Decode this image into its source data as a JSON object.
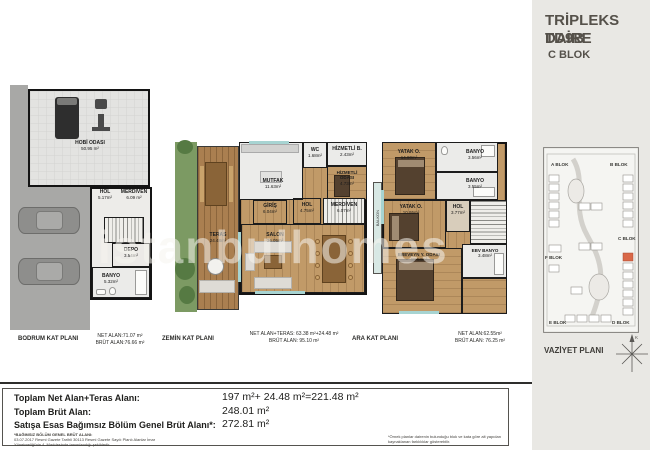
{
  "header": {
    "title": "TRİPLEKS DAİRE",
    "unit": "TD9B",
    "block": "C BLOK"
  },
  "watermark": "istanbulhomes",
  "plans": {
    "bodrum": {
      "title": "BODRUM KAT PLANI",
      "net": "NET ALAN:71.07 m²",
      "brut": "BRÜT ALAN:76.66 m²",
      "rooms": {
        "hobi": {
          "label": "HOBİ ODASI",
          "area": "50.95 m²"
        },
        "hol": {
          "label": "HOL",
          "area": "5.17m²"
        },
        "merdiven": {
          "label": "MERDİVEN",
          "area": "6.09 m²"
        },
        "depo": {
          "label": "DEPO",
          "area": "3.54m²"
        },
        "banyo": {
          "label": "BANYO",
          "area": "5.32m²"
        }
      }
    },
    "zemin": {
      "title": "ZEMİN KAT PLANI",
      "net": "NET ALAN+TERAS: 63.38 m²+24.48 m²",
      "brut": "BRÜT ALAN: 95.10 m²",
      "rooms": {
        "mutfak": {
          "label": "MUTFAK",
          "area": "11.63m²"
        },
        "wc": {
          "label": "WC",
          "area": "1.68m²"
        },
        "hizmetli_b": {
          "label": "HİZMETLİ B.",
          "area": "2.43m²"
        },
        "hizmetli_o": {
          "label": "HİZMETLİ ODASI",
          "area": "4.73m²"
        },
        "giris": {
          "label": "GİRİŞ",
          "area": "6.04m²"
        },
        "hol": {
          "label": "HOL",
          "area": "4.75m²"
        },
        "merdiven": {
          "label": "MERDİVEN",
          "area": "6.07m²"
        },
        "teras": {
          "label": "TERAS",
          "area": "24.48m²"
        },
        "salon": {
          "label": "SALON",
          "area": "36.05m²"
        }
      }
    },
    "ara": {
      "title": "ARA KAT PLANI",
      "net": "NET ALAN:62.55m²",
      "brut": "BRÜT ALAN: 76.25 m²",
      "rooms": {
        "yatak1": {
          "label": "YATAK O.",
          "area": "14.90m²"
        },
        "banyo1": {
          "label": "BANYO",
          "area": "3.56m²"
        },
        "banyo2": {
          "label": "BANYO",
          "area": "3.55m²"
        },
        "yatak2": {
          "label": "YATAK O.",
          "area": "10.95m²"
        },
        "hol": {
          "label": "HOL",
          "area": "3.77m²"
        },
        "ebeveyn": {
          "label": "EBEVEYN Y. ODASI",
          "area": "18.58m²"
        },
        "ebv_banyo": {
          "label": "EBV BANYO",
          "area": "3.48m²"
        },
        "balkon": {
          "label": "BALKON"
        }
      }
    }
  },
  "site": {
    "label": "VAZİYET PLANI",
    "compass": "K",
    "highlight_color": "#d96848",
    "blocks": {
      "a": "A BLOK",
      "b": "B BLOK",
      "c": "C BLOK",
      "d": "D BLOK",
      "e": "E BLOK",
      "f": "F BLOK"
    }
  },
  "summary": {
    "rows": [
      {
        "label": "Toplam Net Alan+Teras Alanı:",
        "value": "197 m²+ 24.48 m²=221.48 m²"
      },
      {
        "label": "Toplam Brüt Alan:",
        "value": "248.01 m²"
      },
      {
        "label": "Satışa Esas Bağımsız Bölüm Genel Brüt Alanı*:",
        "value": "272.81 m²"
      }
    ],
    "footnote_left_title": "*BAĞIMSIZ BÖLÜM GENEL BRÜT ALANI:",
    "footnote_left_body": "03.07.2017 Resmi Gazete Tarihli 30113 Resmi Gazete Sayılı Planlı Alanlar İmar Yönetmeliği'nin 4. Maddesinde tanımlandığı şekildedir.",
    "footnote_right": "*Örnek planlar dairenin bulunduğu blok ve kata göre alt yapıdan kaynaklanan farklılıklar gösterebilir."
  }
}
